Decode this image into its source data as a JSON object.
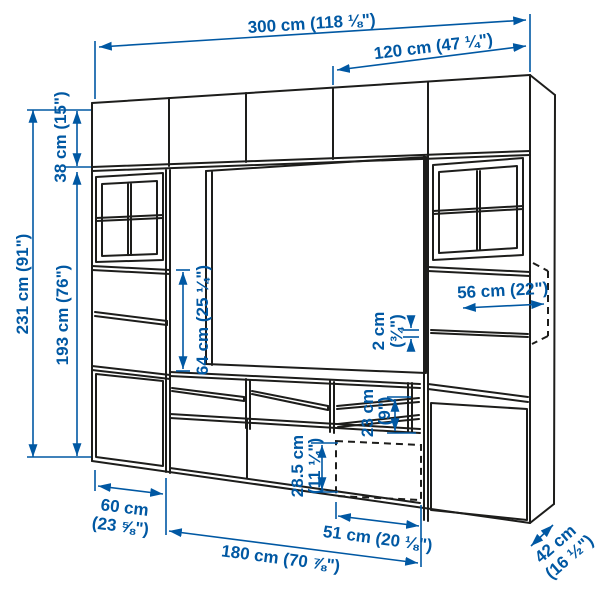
{
  "colors": {
    "dimension_blue": "#0058a3",
    "drawing_line": "#1d1d1b",
    "background": "#ffffff"
  },
  "dims": {
    "w300": "300 cm (118 ⅛\")",
    "w120": "120 cm (47 ¼\")",
    "h231": "231 cm (91\")",
    "h38": "38 cm (15\")",
    "h193": "193 cm (76\")",
    "h64": "64 cm (25 ¼\")",
    "d56": "56 cm (22\")",
    "t2": {
      "l1": "2 cm",
      "l2": "(¾\")"
    },
    "h23": {
      "l1": "23 cm",
      "l2": "(9\")"
    },
    "h285": {
      "l1": "28.5 cm",
      "l2": "(11 ¼\")"
    },
    "w60": {
      "l1": "60 cm",
      "l2": "(23 ⅝\")"
    },
    "w51": "51 cm (20 ⅛\")",
    "w180": "180 cm (70 ⅞\")",
    "d42": {
      "l1": "42 cm",
      "l2": "(16 ½\")"
    }
  }
}
